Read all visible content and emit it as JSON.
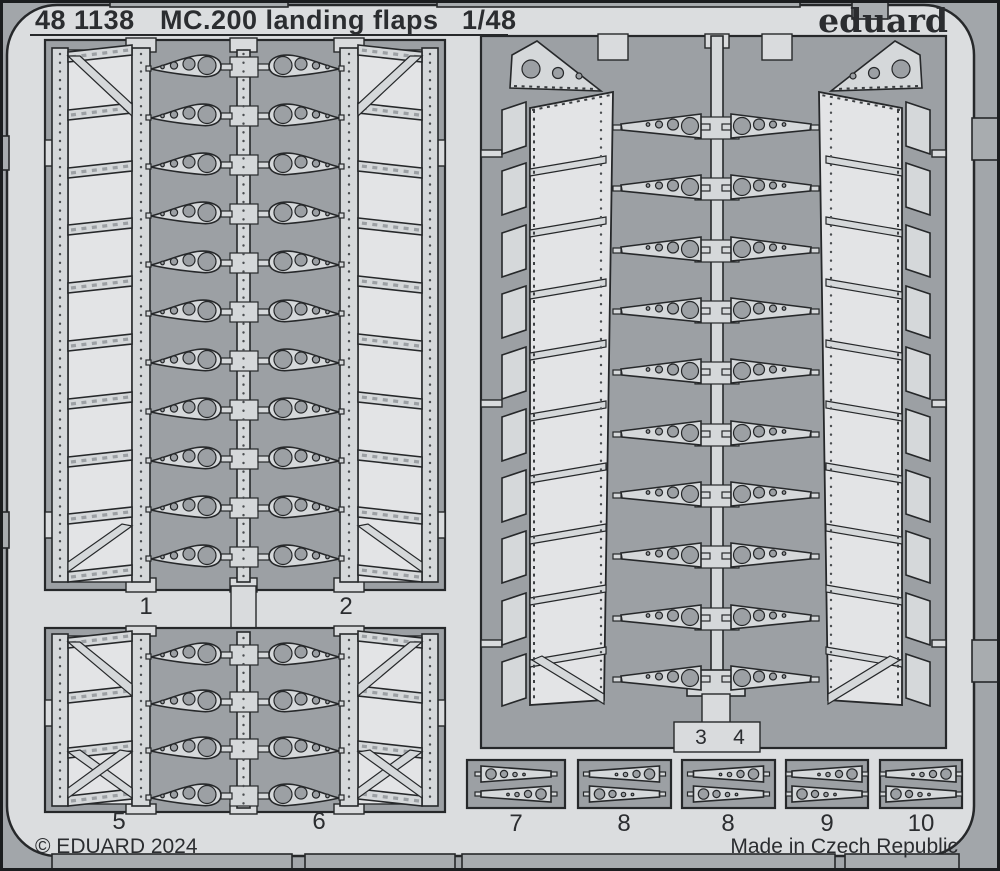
{
  "header": {
    "catalog": "48 1138",
    "title": "MC.200 landing flaps",
    "scale": "1/48",
    "brand": "eduard"
  },
  "footer": {
    "copyright": "© EDUARD 2024",
    "made_in": "Made in Czech Republic"
  },
  "part_labels": [
    {
      "label": "1"
    },
    {
      "label": "2"
    },
    {
      "label": "3"
    },
    {
      "label": "4"
    },
    {
      "label": "5"
    },
    {
      "label": "6"
    },
    {
      "label": "7"
    },
    {
      "label": "8"
    },
    {
      "label": "8"
    },
    {
      "label": "9"
    },
    {
      "label": "10"
    }
  ],
  "colors": {
    "sheet": "#dbdddf",
    "etched_background": "#9ca0a4",
    "metal_part": "#d5d8da",
    "half_etched_panel": "#e3e4e6",
    "outline": "#26282a",
    "text": "#2b2d30",
    "outer_margin": "#a2a6aa"
  }
}
